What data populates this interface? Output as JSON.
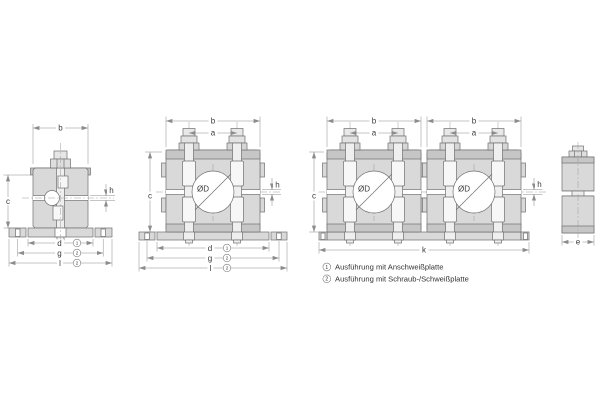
{
  "drawing": {
    "labels": {
      "b": "b",
      "a": "a",
      "c": "c",
      "d": "d",
      "e": "e",
      "g": "g",
      "h": "h",
      "k": "k",
      "l": "l",
      "diameter": "ØD"
    },
    "refs": {
      "weld": "1",
      "screw": "2"
    },
    "legend": [
      {
        "ref": "1",
        "text": "Ausführung mit Anschweißplatte"
      },
      {
        "ref": "2",
        "text": "Ausführung mit Schraub-/Schweißplatte"
      }
    ],
    "colors": {
      "background": "#ffffff",
      "body_fill": "#d9d9d9",
      "band_fill": "#c6c6c6",
      "bolt_fill": "#efefef",
      "outline": "#6f6f6f",
      "dimension_line": "#8c8c8c",
      "text": "#3a3a3a"
    }
  }
}
